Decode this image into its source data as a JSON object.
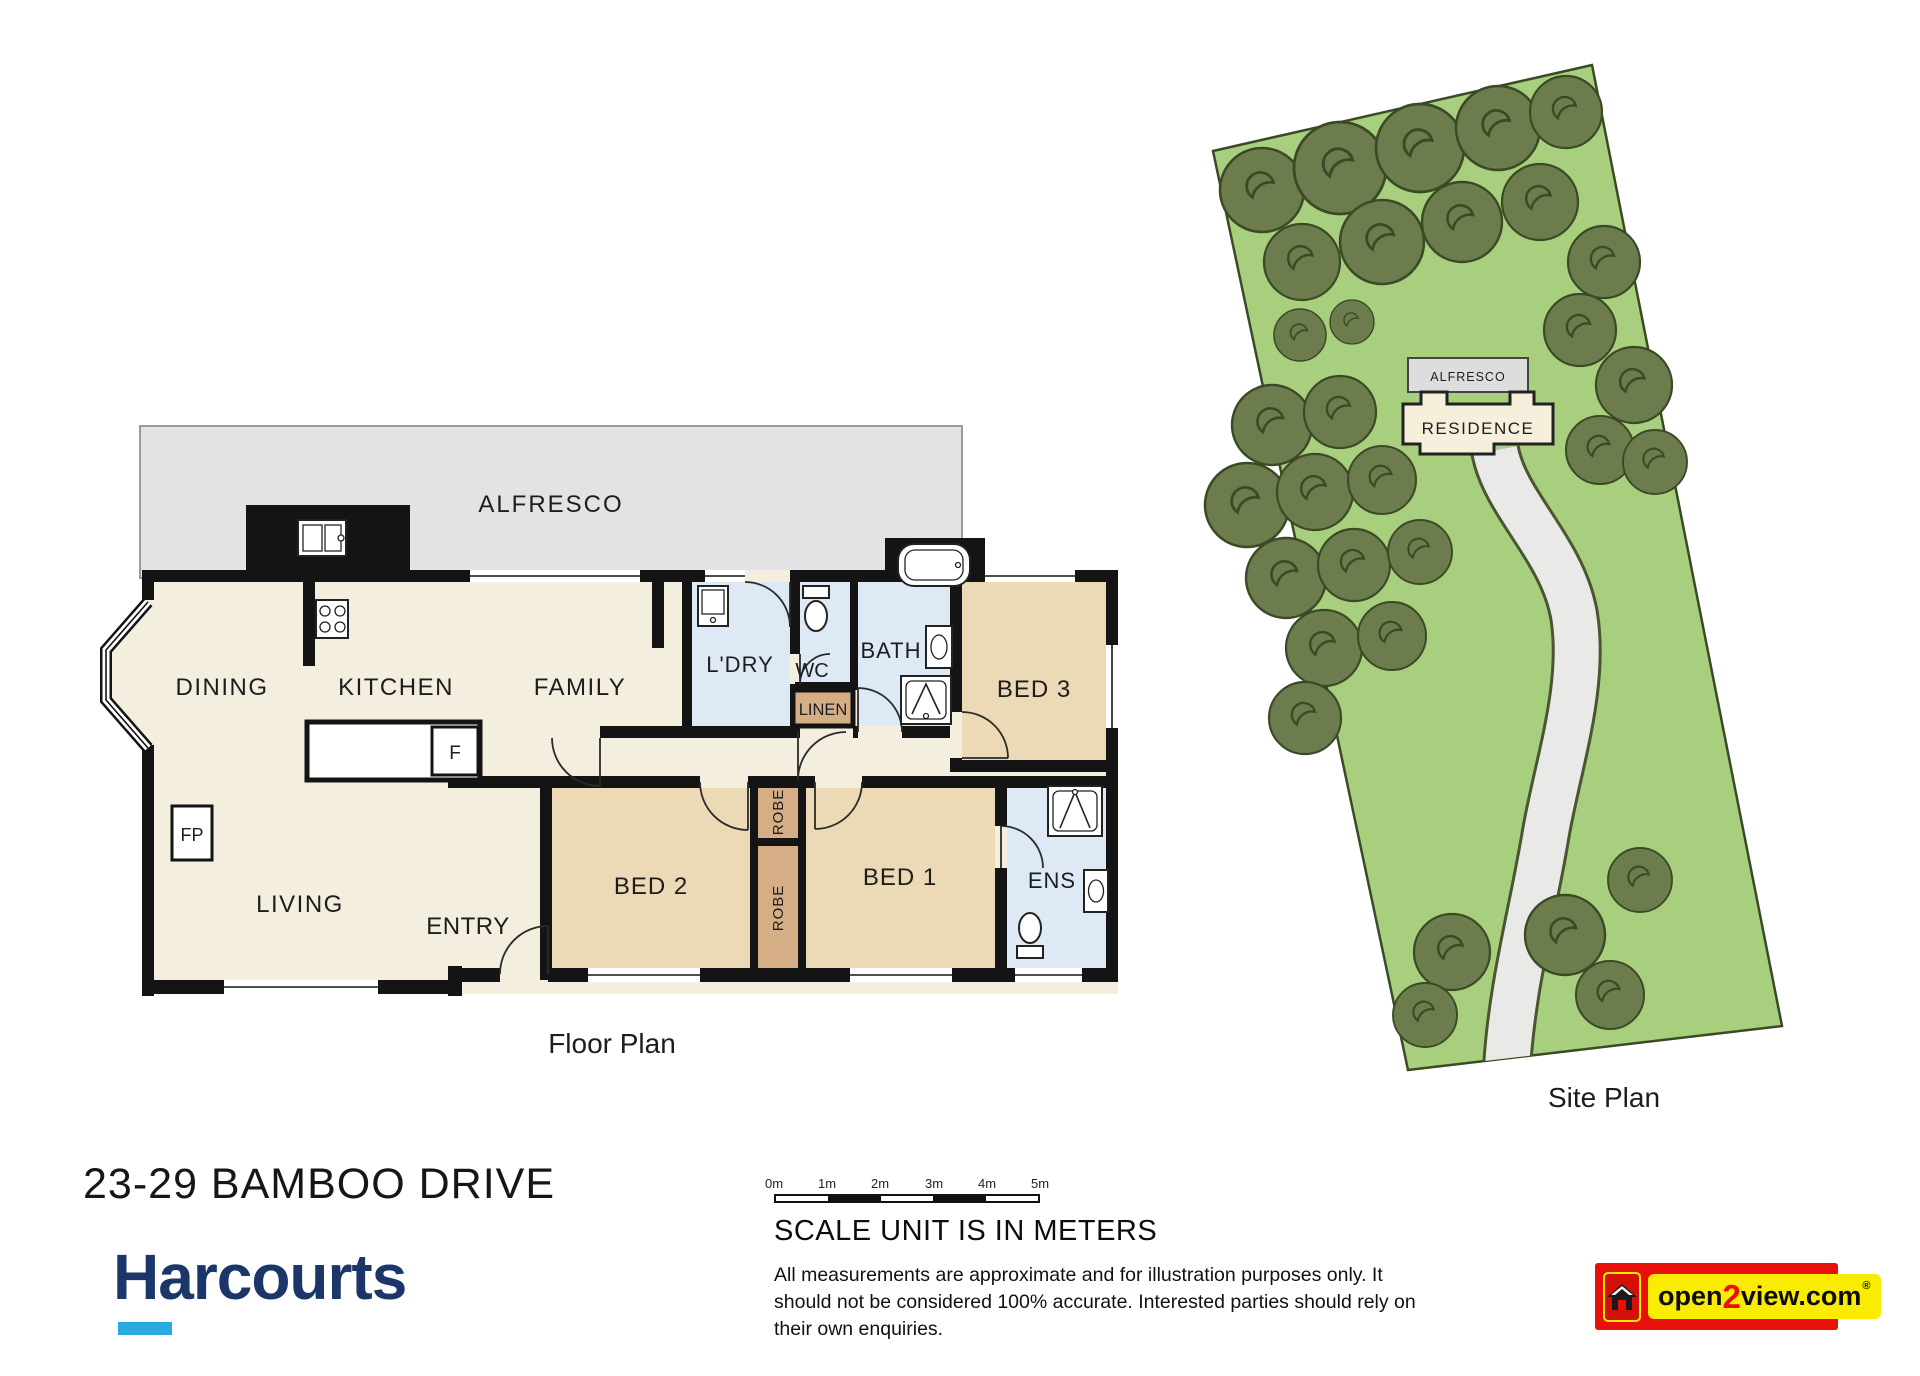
{
  "page": {
    "address": "23-29 BAMBOO DRIVE"
  },
  "floor_plan": {
    "caption": "Floor Plan",
    "labels": {
      "alfresco": "ALFRESCO",
      "dining": "DINING",
      "kitchen": "KITCHEN",
      "family": "FAMILY",
      "laundry": "L'DRY",
      "wc": "WC",
      "bath": "BATH",
      "linen": "LINEN",
      "bed3": "BED 3",
      "bed2": "BED 2",
      "bed1": "BED 1",
      "ens": "ENS",
      "living": "LIVING",
      "entry": "ENTRY",
      "robe": "ROBE",
      "fridge": "F",
      "fireplace": "FP"
    }
  },
  "site_plan": {
    "caption": "Site Plan",
    "labels": {
      "alfresco": "ALFRESCO",
      "residence": "RESIDENCE"
    }
  },
  "scale": {
    "ticks": [
      "0m",
      "1m",
      "2m",
      "3m",
      "4m",
      "5m"
    ],
    "heading": "SCALE UNIT IS IN METERS",
    "disclaimer": [
      "All measurements are approximate and for illustration purposes only. It",
      "should not be considered 100% accurate. Interested parties should rely on",
      "their own enquiries."
    ]
  },
  "branding": {
    "agency": "Harcourts",
    "navy": "#1b3668",
    "cyan": "#29aae1"
  },
  "credit": {
    "open": "open",
    "two": "2",
    "view": "view.com",
    "registered": "®"
  },
  "colors": {
    "wall": "#141414",
    "room_cream": "#f4eede",
    "bedroom_tan": "#ebdab5",
    "wet_blue": "#dde9f4",
    "robe_brown": "#d5ae85",
    "alfresco_gray": "#e3e3e3",
    "grass": "#a8cf7d",
    "tree": "#6c7c4c",
    "tree_outline": "#3b4a26",
    "driveway": "#e9e9e7",
    "open2view_red": "#e8110a",
    "open2view_yellow": "#f9ec00"
  }
}
